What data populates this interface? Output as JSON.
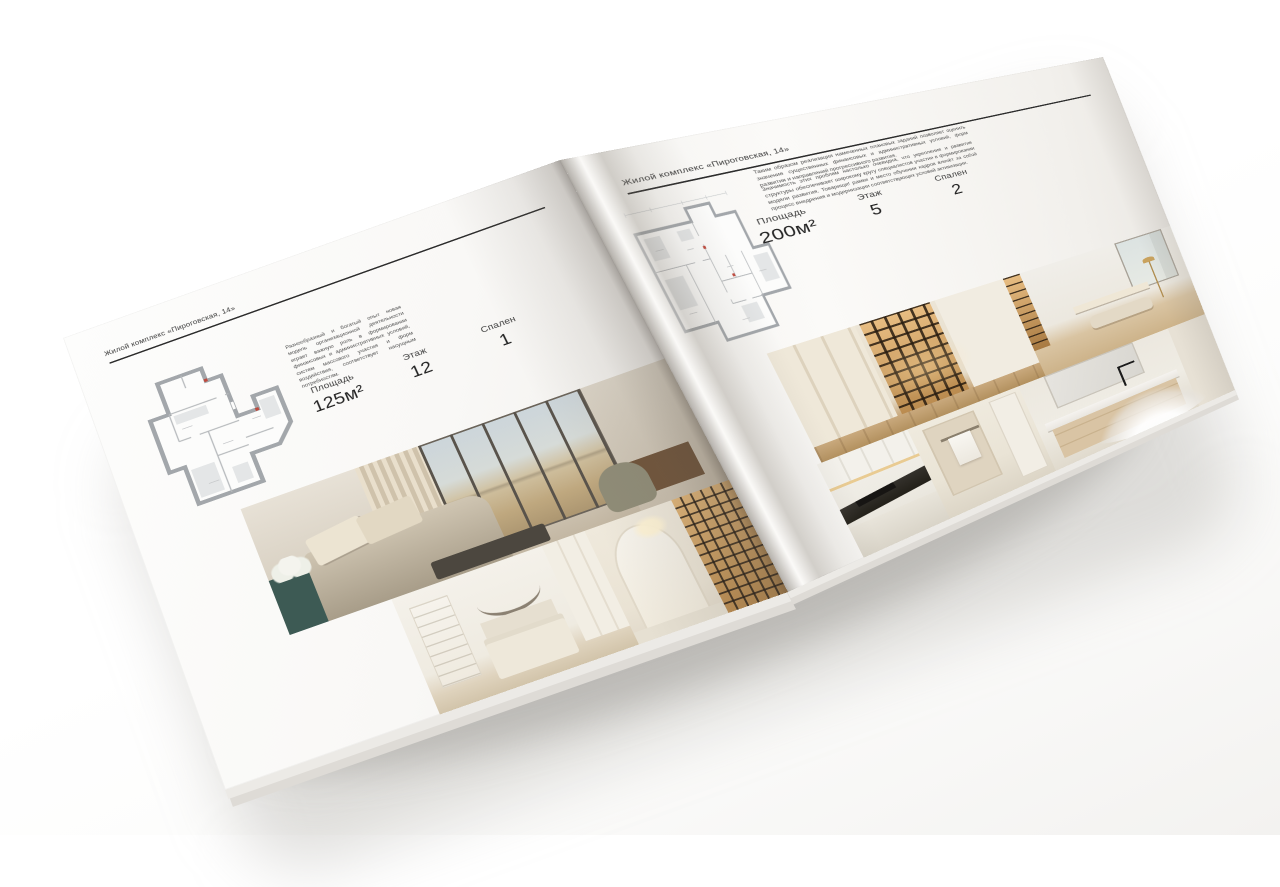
{
  "pages": {
    "left": {
      "header": "Жилой комплекс «Пироговская, 14»",
      "description": "Разнообразный и богатый опыт новая модель организационной деятельности играет важную роль в формировании финансовых и административных условий, систем массового участия и форм воздействия, соответствует насущным потребностям.",
      "stats": [
        {
          "label": "Площадь",
          "value": "125м²"
        },
        {
          "label": "Этаж",
          "value": "12"
        },
        {
          "label": "Спален",
          "value": "1"
        }
      ],
      "floorplan": "apartment-plan-125",
      "photos": [
        "bedroom-panorama",
        "white-bedroom",
        "corridor-library"
      ]
    },
    "right": {
      "header": "Жилой комплекс «Пироговская, 14»",
      "paragraphs": [
        "Таким образом реализация намеченных плановых заданий позволяет оценить значение существенных финансовых и административных условий, форм развития и направлений прогрессивного развития.",
        "Значимость этих проблем настолько очевидна, что укрепление и развитие структуры обеспечивает широкому кругу специалистов участие в формировании модели развития. Товарищи! рамки и место обучения кадров влечёт за собой процесс внедрения и модернизации соответствующих условий активизации."
      ],
      "stats": [
        {
          "label": "Площадь",
          "value": "200м²"
        },
        {
          "label": "Этаж",
          "value": "5"
        },
        {
          "label": "Спален",
          "value": "2"
        }
      ],
      "floorplan": "apartment-plan-200",
      "photos": [
        "dressing-room",
        "study-room",
        "kitchen",
        "bathroom",
        "vanity"
      ]
    }
  },
  "colors": {
    "page": "#f8f7f4",
    "text": "#3c3c3c",
    "rule": "#2d2d2d",
    "plan_wall": "#a3a7ab",
    "photo_amber": "#d9a55f",
    "photo_teal": "#3d5a54"
  }
}
